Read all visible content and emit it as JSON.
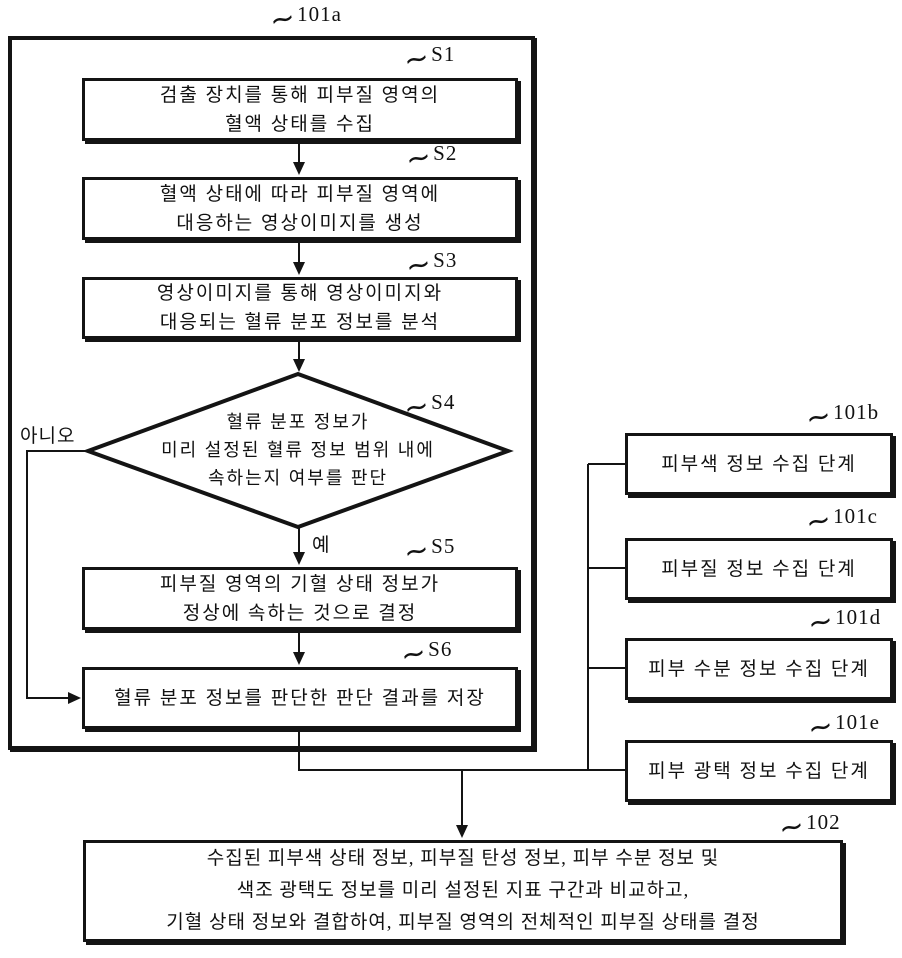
{
  "drawing": {
    "tilde": "~",
    "colors": {
      "ink": "#141414",
      "background": "#ffffff"
    }
  },
  "flowchart": {
    "group_id": "101a",
    "steps": [
      {
        "id": "S1",
        "type": "process",
        "lines": [
          "검출 장치를 통해 피부질 영역의",
          "혈액 상태를 수집"
        ]
      },
      {
        "id": "S2",
        "type": "process",
        "lines": [
          "혈액 상태에 따라 피부질 영역에",
          "대응하는 영상이미지를 생성"
        ]
      },
      {
        "id": "S3",
        "type": "process",
        "lines": [
          "영상이미지를 통해 영상이미지와",
          "대응되는 혈류 분포 정보를 분석"
        ]
      },
      {
        "id": "S4",
        "type": "decision",
        "lines": [
          "혈류 분포 정보가",
          "미리 설정된 혈류 정보 범위 내에",
          "속하는지 여부를 판단"
        ],
        "yes_label": "예",
        "no_label": "아니오"
      },
      {
        "id": "S5",
        "type": "process",
        "lines": [
          "피부질 영역의 기혈 상태 정보가",
          "정상에 속하는 것으로 결정"
        ]
      },
      {
        "id": "S6",
        "type": "process",
        "lines": [
          "혈류 분포 정보를 판단한 판단 결과를 저장"
        ]
      }
    ],
    "side_steps": [
      {
        "id": "101b",
        "text": "피부색 정보 수집 단계"
      },
      {
        "id": "101c",
        "text": "피부질 정보 수집 단계"
      },
      {
        "id": "101d",
        "text": "피부 수분 정보 수집 단계"
      },
      {
        "id": "101e",
        "text": "피부 광택 정보 수집 단계"
      }
    ],
    "final_step": {
      "id": "102",
      "lines": [
        "수집된 피부색 상태 정보, 피부질 탄성 정보, 피부 수분 정보 및",
        "색조 광택도 정보를 미리 설정된 지표 구간과 비교하고,",
        "기혈 상태 정보와 결합하여, 피부질 영역의 전체적인 피부질 상태를 결정"
      ]
    }
  }
}
